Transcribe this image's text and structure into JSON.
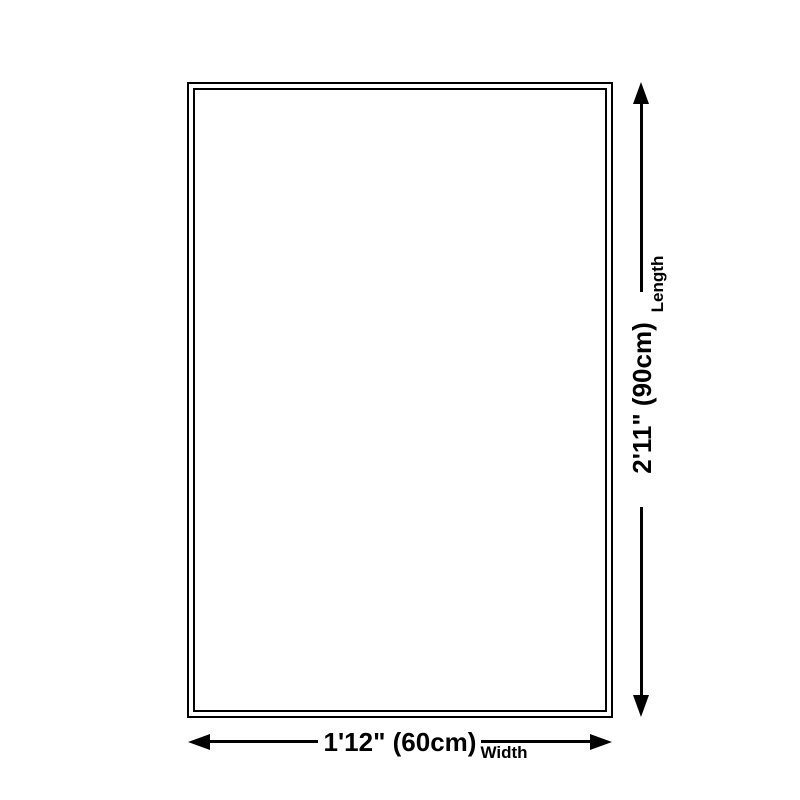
{
  "diagram": {
    "type": "product-dimension-diagram",
    "shape": "rectangle",
    "background_color": "#ffffff",
    "line_color": "#000000",
    "length": {
      "value": "2'11\" (90cm)",
      "label": "Length"
    },
    "width": {
      "value": "1'12\" (60cm)",
      "label": "Width"
    }
  }
}
